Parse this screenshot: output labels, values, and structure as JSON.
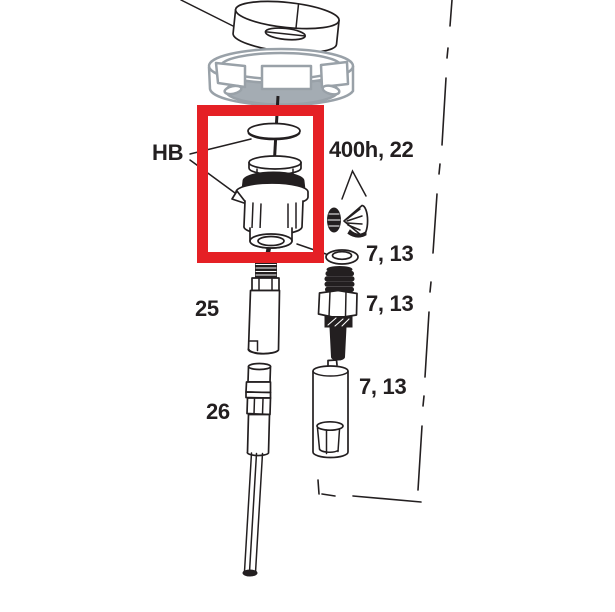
{
  "colors": {
    "highlight_red": "#e52025",
    "line": "#231f20",
    "gray_stroke": "#99a1a8",
    "gray_fill": "#a4acb3"
  },
  "labels": {
    "hb": "HB",
    "group_400h": "400h, 22",
    "seven_13_a": "7, 13",
    "seven_13_b": "7, 13",
    "seven_13_c": "7, 13",
    "part_25": "25",
    "part_26": "26"
  }
}
